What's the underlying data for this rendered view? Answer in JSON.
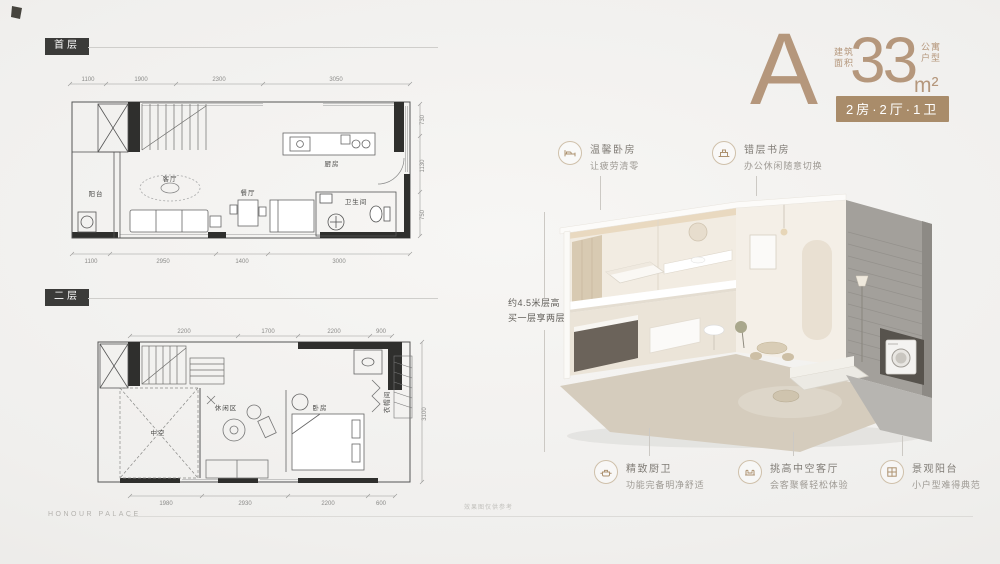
{
  "brand": {
    "name": "HONOUR PALACE",
    "disclaimer": "效果图仅供参考"
  },
  "unit": {
    "letter": "A",
    "area_label_row1": "建筑",
    "area_label_row2": "面积",
    "area_value": "33",
    "area_unit": "m²",
    "type_row1": "公寓",
    "type_row2": "户型",
    "spec": "2房·2厅·1卫"
  },
  "height_note": {
    "line1": "约4.5米层高",
    "line2": "买一层享两层"
  },
  "callouts": [
    {
      "icon": "bed-icon",
      "title": "温馨卧房",
      "desc": "让疲劳清零"
    },
    {
      "icon": "study-icon",
      "title": "错层书房",
      "desc": "办公休闲随意切换"
    },
    {
      "icon": "kitchen-icon",
      "title": "精致厨卫",
      "desc": "功能完备明净舒适"
    },
    {
      "icon": "sofa-icon",
      "title": "挑高中空客厅",
      "desc": "会客聚餐轻松体验"
    },
    {
      "icon": "balcony-icon",
      "title": "景观阳台",
      "desc": "小户型难得典范"
    }
  ],
  "floorplans": {
    "first": {
      "badge": "首层",
      "rooms": {
        "balcony": "阳台",
        "living": "客厅",
        "dining": "餐厅",
        "bathroom": "卫生间",
        "kitchen": "厨房"
      },
      "dims_top": [
        "1100",
        "1900",
        "2300",
        "3050"
      ],
      "dims_bottom": [
        "1100",
        "2950",
        "1400",
        "3000"
      ],
      "dims_right": [
        "730",
        "1130",
        "750"
      ]
    },
    "second": {
      "badge": "二层",
      "rooms": {
        "void": "中空",
        "leisure": "休闲区",
        "bedroom": "卧房",
        "closet": "衣帽间"
      },
      "dims_top": [
        "2200",
        "1700",
        "2200",
        "900"
      ],
      "dims_bottom": [
        "1980",
        "2930",
        "2200",
        "600"
      ],
      "dims_right": [
        "3100"
      ]
    }
  },
  "colors": {
    "accent": "#b5977c",
    "badge_bg": "#a98c6a",
    "wall": "#2f2f2d"
  }
}
